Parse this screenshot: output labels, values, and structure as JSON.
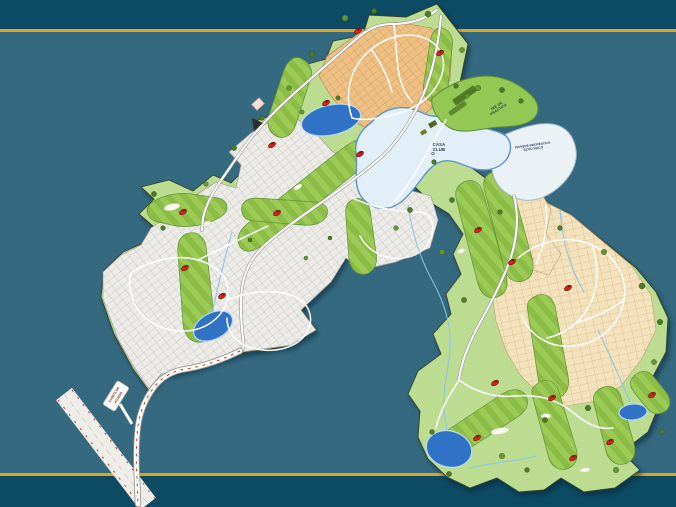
{
  "scene": {
    "description": "Master plan map of a golf residential community on a teal slide background with gold divider lines"
  },
  "colors": {
    "bg_outer": "#0d4a63",
    "bg_inner": "#35697f",
    "divider_gold": "#e8a11d",
    "land_green": "#bcdc92",
    "fairway_green": "#9ccb55",
    "fairway_stripe": "#8abc46",
    "tree_green": "#4d7a27",
    "lots_gray": "#ecebe7",
    "lots_tan": "#eec084",
    "lots_cream": "#f3e2bc",
    "lake_blue": "#2f72c6",
    "lagoon_blue": "#e2eef8",
    "road_white": "#fefefe",
    "flag_red": "#d2251c",
    "label_navy": "#1e2d4f"
  },
  "map": {
    "labels": {
      "casa_club": {
        "line1": "CASA",
        "line2": "CLUB"
      },
      "tee_practica": {
        "line1": "TEE DE",
        "line2": "PRACTICA"
      },
      "parque": {
        "line1": "PARQUE RECREATIVO",
        "line2": "ECOLOGICO"
      },
      "caseta": {
        "line1": "CASETA DE",
        "line2": "ACCESO"
      }
    },
    "flags": [
      [
        358,
        31
      ],
      [
        440,
        53
      ],
      [
        326,
        103
      ],
      [
        272,
        145
      ],
      [
        360,
        154
      ],
      [
        183,
        212
      ],
      [
        277,
        213
      ],
      [
        185,
        268
      ],
      [
        222,
        296
      ],
      [
        478,
        230
      ],
      [
        512,
        262
      ],
      [
        568,
        288
      ],
      [
        495,
        383
      ],
      [
        552,
        398
      ],
      [
        652,
        395
      ],
      [
        610,
        442
      ],
      [
        477,
        438
      ],
      [
        573,
        458
      ]
    ],
    "trees": [
      [
        345,
        18,
        3
      ],
      [
        374,
        11,
        2.6
      ],
      [
        428,
        14,
        3
      ],
      [
        462,
        50,
        2.6
      ],
      [
        456,
        86,
        2.4
      ],
      [
        312,
        54,
        2.8
      ],
      [
        289,
        88,
        2.6
      ],
      [
        262,
        118,
        2.4
      ],
      [
        234,
        148,
        2.6
      ],
      [
        206,
        184,
        2.4
      ],
      [
        154,
        194,
        2.6
      ],
      [
        163,
        228,
        2.4
      ],
      [
        302,
        112,
        2.2
      ],
      [
        338,
        98,
        2.2
      ],
      [
        410,
        210,
        2.6
      ],
      [
        396,
        228,
        2.4
      ],
      [
        434,
        162,
        2.4
      ],
      [
        452,
        200,
        2.6
      ],
      [
        442,
        252,
        2.6
      ],
      [
        464,
        300,
        2.6
      ],
      [
        500,
        212,
        2.4
      ],
      [
        604,
        252,
        2.8
      ],
      [
        642,
        286,
        3
      ],
      [
        660,
        322,
        2.8
      ],
      [
        654,
        362,
        2.6
      ],
      [
        588,
        408,
        2.8
      ],
      [
        545,
        420,
        2.6
      ],
      [
        502,
        456,
        2.8
      ],
      [
        449,
        474,
        2.6
      ],
      [
        432,
        432,
        2.4
      ],
      [
        616,
        470,
        2.8
      ],
      [
        662,
        432,
        2.4
      ],
      [
        527,
        470,
        2.4
      ],
      [
        478,
        88,
        2.8
      ],
      [
        502,
        90,
        2.6
      ],
      [
        521,
        101,
        2.4
      ],
      [
        467,
        96,
        2.2
      ],
      [
        560,
        228,
        2.4
      ],
      [
        250,
        240,
        2
      ],
      [
        306,
        258,
        2
      ],
      [
        330,
        238,
        2
      ]
    ],
    "lakes": [
      {
        "cx": 331,
        "cy": 120,
        "rx": 30,
        "ry": 15,
        "rot": -12
      },
      {
        "cx": 213,
        "cy": 326,
        "rx": 21,
        "ry": 13,
        "rot": -28
      },
      {
        "cx": 449,
        "cy": 449,
        "rx": 23,
        "ry": 18,
        "rot": 15
      },
      {
        "cx": 633,
        "cy": 412,
        "rx": 14,
        "ry": 8,
        "rot": -5
      }
    ]
  }
}
